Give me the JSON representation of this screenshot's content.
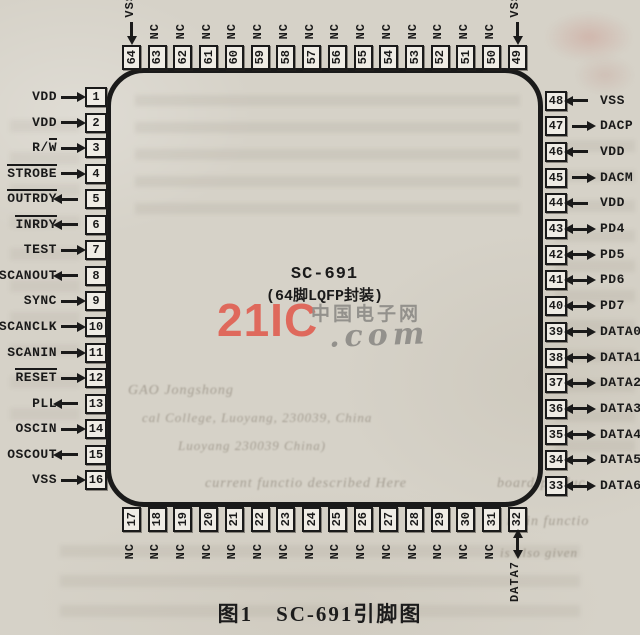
{
  "caption": "图1　SC-691引脚图",
  "chip": {
    "name": "SC-691",
    "package": "(64脚LQFP封装)"
  },
  "watermark": {
    "brand": "21IC",
    "suffix": ".com",
    "site_cn": "中国电子网",
    "brand_color": "#df695c",
    "gray_color": "#93918c"
  },
  "colors": {
    "paper": "#d6d2c8",
    "ink": "#1a1a1a",
    "pin_fill": "#efece5"
  },
  "pins": {
    "left": [
      {
        "num": "1",
        "dir": "in",
        "label": [
          {
            "t": "VDD"
          }
        ]
      },
      {
        "num": "2",
        "dir": "in",
        "label": [
          {
            "t": "VDD"
          }
        ]
      },
      {
        "num": "3",
        "dir": "in",
        "label": [
          {
            "t": "R/"
          },
          {
            "t": "W",
            "ov": true
          }
        ]
      },
      {
        "num": "4",
        "dir": "in",
        "label": [
          {
            "t": "STROBE",
            "ov": true
          }
        ]
      },
      {
        "num": "5",
        "dir": "out",
        "label": [
          {
            "t": "OUTRDY",
            "ov": true
          }
        ]
      },
      {
        "num": "6",
        "dir": "out",
        "label": [
          {
            "t": "INRDY",
            "ov": true
          }
        ]
      },
      {
        "num": "7",
        "dir": "in",
        "label": [
          {
            "t": "TEST"
          }
        ]
      },
      {
        "num": "8",
        "dir": "out",
        "label": [
          {
            "t": "SCANOUT"
          }
        ]
      },
      {
        "num": "9",
        "dir": "in",
        "label": [
          {
            "t": "SYNC"
          }
        ]
      },
      {
        "num": "10",
        "dir": "in",
        "label": [
          {
            "t": "SCANCLK"
          }
        ]
      },
      {
        "num": "11",
        "dir": "in",
        "label": [
          {
            "t": "SCANIN"
          }
        ]
      },
      {
        "num": "12",
        "dir": "in",
        "label": [
          {
            "t": "RESET",
            "ov": true
          }
        ]
      },
      {
        "num": "13",
        "dir": "out",
        "label": [
          {
            "t": "PLL"
          }
        ]
      },
      {
        "num": "14",
        "dir": "in",
        "label": [
          {
            "t": "OSCIN"
          }
        ]
      },
      {
        "num": "15",
        "dir": "out",
        "label": [
          {
            "t": "OSCOUT"
          }
        ]
      },
      {
        "num": "16",
        "dir": "in",
        "label": [
          {
            "t": "VSS"
          }
        ]
      }
    ],
    "top": [
      {
        "num": "64",
        "dir": "in",
        "label": [
          {
            "t": "VSS"
          }
        ]
      },
      {
        "num": "63",
        "dir": "none",
        "label": [
          {
            "t": "NC"
          }
        ]
      },
      {
        "num": "62",
        "dir": "none",
        "label": [
          {
            "t": "NC"
          }
        ]
      },
      {
        "num": "61",
        "dir": "none",
        "label": [
          {
            "t": "NC"
          }
        ]
      },
      {
        "num": "60",
        "dir": "none",
        "label": [
          {
            "t": "NC"
          }
        ]
      },
      {
        "num": "59",
        "dir": "none",
        "label": [
          {
            "t": "NC"
          }
        ]
      },
      {
        "num": "58",
        "dir": "none",
        "label": [
          {
            "t": "NC"
          }
        ]
      },
      {
        "num": "57",
        "dir": "none",
        "label": [
          {
            "t": "NC"
          }
        ]
      },
      {
        "num": "56",
        "dir": "none",
        "label": [
          {
            "t": "NC"
          }
        ]
      },
      {
        "num": "55",
        "dir": "none",
        "label": [
          {
            "t": "NC"
          }
        ]
      },
      {
        "num": "54",
        "dir": "none",
        "label": [
          {
            "t": "NC"
          }
        ]
      },
      {
        "num": "53",
        "dir": "none",
        "label": [
          {
            "t": "NC"
          }
        ]
      },
      {
        "num": "52",
        "dir": "none",
        "label": [
          {
            "t": "NC"
          }
        ]
      },
      {
        "num": "51",
        "dir": "none",
        "label": [
          {
            "t": "NC"
          }
        ]
      },
      {
        "num": "50",
        "dir": "none",
        "label": [
          {
            "t": "NC"
          }
        ]
      },
      {
        "num": "49",
        "dir": "in",
        "label": [
          {
            "t": "VSS"
          }
        ]
      }
    ],
    "right": [
      {
        "num": "48",
        "dir": "in",
        "label": [
          {
            "t": "VSS"
          }
        ]
      },
      {
        "num": "47",
        "dir": "out",
        "label": [
          {
            "t": "DACP"
          }
        ]
      },
      {
        "num": "46",
        "dir": "in",
        "label": [
          {
            "t": "VDD"
          }
        ]
      },
      {
        "num": "45",
        "dir": "out",
        "label": [
          {
            "t": "DACM"
          }
        ]
      },
      {
        "num": "44",
        "dir": "in",
        "label": [
          {
            "t": "VDD"
          }
        ]
      },
      {
        "num": "43",
        "dir": "bi",
        "label": [
          {
            "t": "PD4"
          }
        ]
      },
      {
        "num": "42",
        "dir": "bi",
        "label": [
          {
            "t": "PD5"
          }
        ]
      },
      {
        "num": "41",
        "dir": "bi",
        "label": [
          {
            "t": "PD6"
          }
        ]
      },
      {
        "num": "40",
        "dir": "bi",
        "label": [
          {
            "t": "PD7"
          }
        ]
      },
      {
        "num": "39",
        "dir": "bi",
        "label": [
          {
            "t": "DATA0"
          }
        ]
      },
      {
        "num": "38",
        "dir": "bi",
        "label": [
          {
            "t": "DATA1"
          }
        ]
      },
      {
        "num": "37",
        "dir": "bi",
        "label": [
          {
            "t": "DATA2"
          }
        ]
      },
      {
        "num": "36",
        "dir": "bi",
        "label": [
          {
            "t": "DATA3"
          }
        ]
      },
      {
        "num": "35",
        "dir": "bi",
        "label": [
          {
            "t": "DATA4"
          }
        ]
      },
      {
        "num": "34",
        "dir": "bi",
        "label": [
          {
            "t": "DATA5"
          }
        ]
      },
      {
        "num": "33",
        "dir": "bi",
        "label": [
          {
            "t": "DATA6"
          }
        ]
      }
    ],
    "bottom": [
      {
        "num": "17",
        "dir": "none",
        "label": [
          {
            "t": "NC"
          }
        ]
      },
      {
        "num": "18",
        "dir": "none",
        "label": [
          {
            "t": "NC"
          }
        ]
      },
      {
        "num": "19",
        "dir": "none",
        "label": [
          {
            "t": "NC"
          }
        ]
      },
      {
        "num": "20",
        "dir": "none",
        "label": [
          {
            "t": "NC"
          }
        ]
      },
      {
        "num": "21",
        "dir": "none",
        "label": [
          {
            "t": "NC"
          }
        ]
      },
      {
        "num": "22",
        "dir": "none",
        "label": [
          {
            "t": "NC"
          }
        ]
      },
      {
        "num": "23",
        "dir": "none",
        "label": [
          {
            "t": "NC"
          }
        ]
      },
      {
        "num": "24",
        "dir": "none",
        "label": [
          {
            "t": "NC"
          }
        ]
      },
      {
        "num": "25",
        "dir": "none",
        "label": [
          {
            "t": "NC"
          }
        ]
      },
      {
        "num": "26",
        "dir": "none",
        "label": [
          {
            "t": "NC"
          }
        ]
      },
      {
        "num": "27",
        "dir": "none",
        "label": [
          {
            "t": "NC"
          }
        ]
      },
      {
        "num": "28",
        "dir": "none",
        "label": [
          {
            "t": "NC"
          }
        ]
      },
      {
        "num": "29",
        "dir": "none",
        "label": [
          {
            "t": "NC"
          }
        ]
      },
      {
        "num": "30",
        "dir": "none",
        "label": [
          {
            "t": "NC"
          }
        ]
      },
      {
        "num": "31",
        "dir": "none",
        "label": [
          {
            "t": "NC"
          }
        ]
      },
      {
        "num": "32",
        "dir": "bi",
        "label": [
          {
            "t": "DATA7"
          }
        ]
      }
    ]
  },
  "ghost_text": {
    "fragments": [
      {
        "t": "GAO Jongshong",
        "x": 128,
        "y": 383,
        "s": 14
      },
      {
        "t": "cal College, Luoyang, 230039, China",
        "x": 142,
        "y": 410,
        "s": 13
      },
      {
        "t": "Luoyang 230039 China)",
        "x": 178,
        "y": 438,
        "s": 13
      },
      {
        "t": "current functio described Here",
        "x": 205,
        "y": 476,
        "s": 14
      },
      {
        "t": "board-produc",
        "x": 497,
        "y": 476,
        "s": 14
      },
      {
        "t": "s main functio",
        "x": 496,
        "y": 514,
        "s": 14
      },
      {
        "t": "is also given",
        "x": 500,
        "y": 545,
        "s": 13
      }
    ]
  }
}
